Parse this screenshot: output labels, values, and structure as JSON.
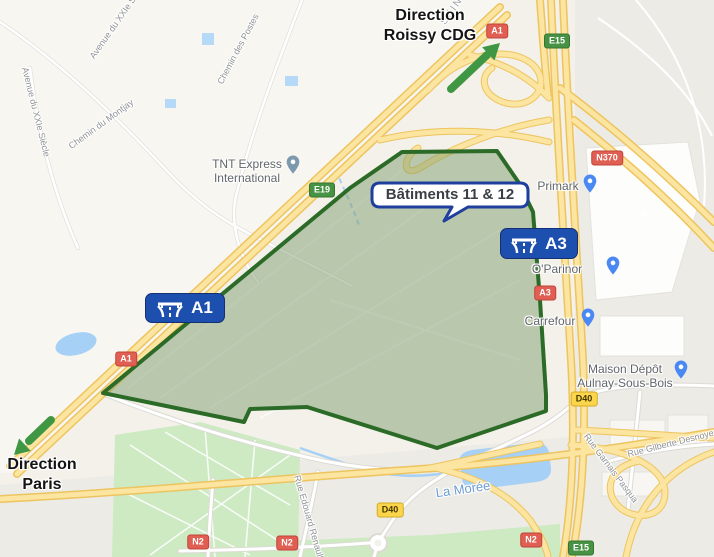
{
  "overlay": {
    "direction_top": {
      "line1": "Direction",
      "line2": "Roissy CDG"
    },
    "direction_bottom": {
      "line1": "Direction",
      "line2": "Paris"
    },
    "callout_label": "Bâtiments 11 & 12",
    "motorway_badges": [
      {
        "label": "A1"
      },
      {
        "label": "A3"
      }
    ],
    "arrow_color": "#3f9643"
  },
  "route_shields": [
    {
      "label": "A1",
      "type": "red"
    },
    {
      "label": "E15",
      "type": "green"
    },
    {
      "label": "E19",
      "type": "green"
    },
    {
      "label": "N370",
      "type": "red"
    },
    {
      "label": "A1",
      "type": "red"
    },
    {
      "label": "A3",
      "type": "red"
    },
    {
      "label": "D40",
      "type": "yellow"
    },
    {
      "label": "D40",
      "type": "yellow"
    },
    {
      "label": "N2",
      "type": "red"
    },
    {
      "label": "N2",
      "type": "red"
    },
    {
      "label": "N2",
      "type": "red"
    },
    {
      "label": "E15",
      "type": "green"
    }
  ],
  "pois": [
    {
      "name": "TNT Express International"
    },
    {
      "name": "Primark"
    },
    {
      "name": "O'Parinor"
    },
    {
      "name": "Carrefour"
    },
    {
      "name": "Maison Dépôt Aulnay-Sous-Bois"
    }
  ],
  "water_labels": [
    {
      "name": "La Morée"
    }
  ],
  "street_labels": [
    {
      "name": "Avenue du XXIe Siècle"
    },
    {
      "name": "Avenue du XXIe Siècle"
    },
    {
      "name": "Chemin des Postes"
    },
    {
      "name": "Chemin du Montjay"
    },
    {
      "name": "Rue Edouard Renault"
    },
    {
      "name": "Rue Gilberte Desnoyer"
    },
    {
      "name": "Rue Garnais Pasqua"
    },
    {
      "name": "SEIN"
    }
  ],
  "colors": {
    "polygon_border": "#2c6b27",
    "polygon_fill": "#7f9e6e",
    "arrow_green": "#3f9643",
    "motorway_badge_blue": "#1d4faf",
    "shield_red": "#e05f52",
    "shield_green": "#479244",
    "shield_yellow": "#fbd54b",
    "road_yellow": "#fce5a0",
    "water_blue": "#a6d0f5",
    "park_green": "#cdeac3"
  }
}
